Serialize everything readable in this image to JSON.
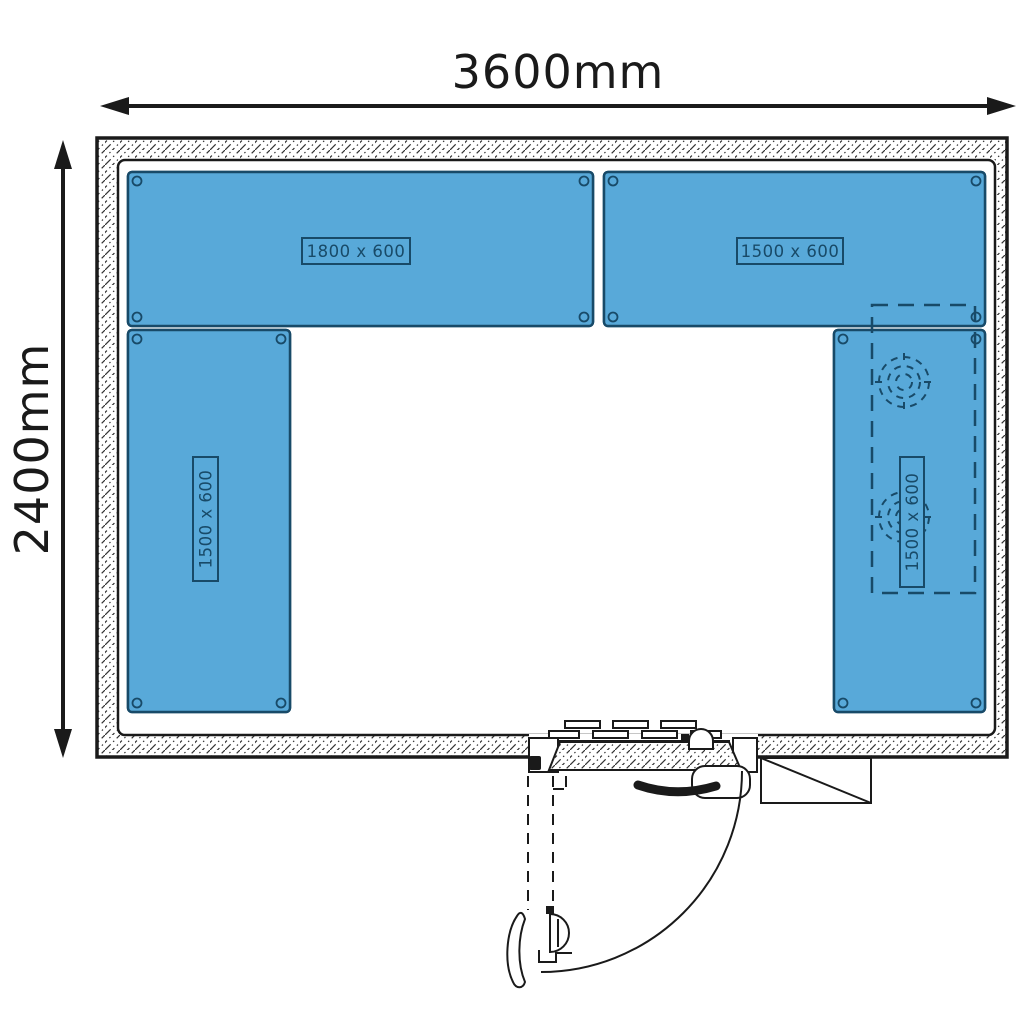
{
  "dimension_labels": {
    "width": "3600mm",
    "height": "2400mm"
  },
  "bench_labels": {
    "top_left": "1800 x 600",
    "top_right": "1500 x 600",
    "left": "1500 x 600",
    "right": "1500 x 600"
  },
  "colors": {
    "line": "#1a1a1a",
    "bench_fill": "#58a9d9",
    "bench_line": "#184a68",
    "background": "#ffffff"
  }
}
